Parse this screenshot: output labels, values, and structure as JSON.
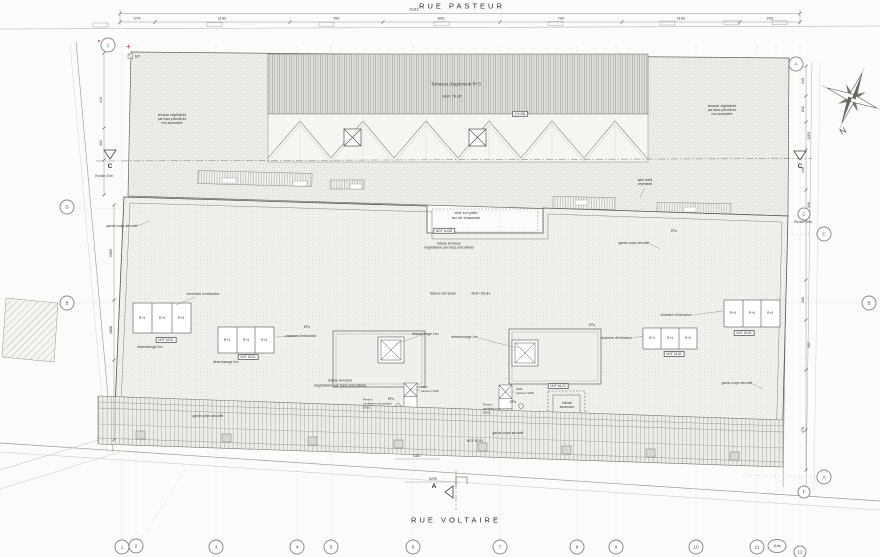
{
  "streets": {
    "top": "RUE  PASTEUR",
    "bottom": "RUE  VOLTAIRE"
  },
  "compass": {
    "north": "N"
  },
  "sections": {
    "c": "C",
    "a": "A",
    "ronde": "Ronde 20m"
  },
  "upper": {
    "title": "Terrasse d'agrément   R+3",
    "ngf": "NGF 70.87",
    "level": "(+4.05)",
    "green_note": "terrasse végétalisée\npar bacs précultivés\nnon accessible"
  },
  "patio": {
    "vide": "vide sur patio\nrez de chaussée",
    "ngf": "NGF 64.65",
    "note": "toiture terrasse\nvégétalisée par bacs précultivés"
  },
  "roof": {
    "toiture": "toiture terrasse",
    "ngf": "NGF 63.81",
    "green_note": "toiture terrasse\nvégétalisée par bacs précultivés",
    "garde": "garde-corps sécurité",
    "pare_soleil": "pare soleil\nvégétalisé",
    "cheminee": "cheminée d'extraction",
    "chambre": "chambre d'extraction",
    "r4": "R+4",
    "desenf1": "désenfumage 1m²",
    "desenf2": "désenfumage 2m²",
    "vmc": "VMC\ncaisson VMC",
    "ev01": "Pentes\nventilation secondaire\nEV01",
    "ev02": "Pentes\nventilation secondaire\nEV02",
    "edicule_ngf": "NGF 66.22",
    "edicule": "édicule\nascenseur",
    "ep": "EP",
    "eps": "EPs"
  },
  "dims": {
    "top_total": "6183",
    "top": [
      "279",
      "1192",
      "760",
      "843",
      "790",
      "1192",
      "293"
    ],
    "left": [
      "443",
      "302",
      "2689",
      "1888"
    ],
    "right": [
      "440",
      "842",
      "1118",
      "448",
      "346",
      "330",
      "162",
      "478"
    ],
    "bottom": [
      "5387",
      "5290"
    ]
  },
  "grid": {
    "bottom": [
      "1",
      "2",
      "3",
      "4",
      "5",
      "6",
      "7",
      "8",
      "9",
      "10",
      "11",
      "11bis",
      "12"
    ],
    "left": [
      "1",
      "D",
      "B"
    ],
    "right": [
      "A",
      "C",
      "C",
      "B",
      "A",
      "F"
    ]
  }
}
